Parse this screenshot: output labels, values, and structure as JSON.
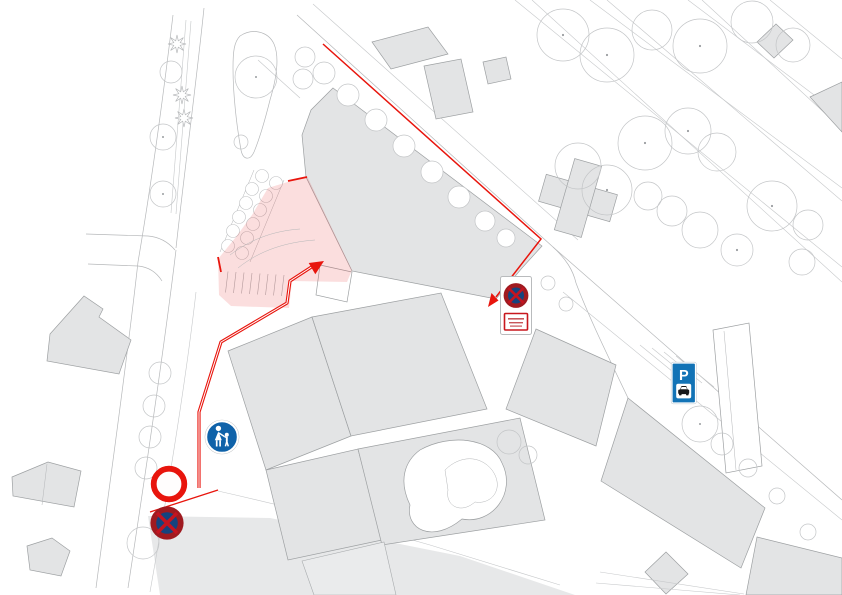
{
  "map": {
    "kind": "site-plan with pedestrian zone highlight and traffic signs",
    "colors": {
      "route_red": "#e8150d",
      "zone_pink": "rgba(230,60,60,0.17)",
      "sign_blue": "#0f62a9",
      "parking_blue": "#1273b6",
      "no_stop_ring": "#9f1a20",
      "no_stop_blue": "#15437e",
      "no_stop_cross": "#c41420",
      "building_gray": "#e3e4e5"
    },
    "highlight_zone": {
      "fill": "rgba(230,60,60,0.17)",
      "points": "268,188 307,176 352,270 347,282 292,281 289,308 231,306 219,295 218,259 236,237 252,215",
      "edge_top": "M288,181 L307,177",
      "edge_left": "M218,257 L221,272"
    },
    "route": {
      "street_line": {
        "points": "323,44 541,239 496,297"
      },
      "street_arrowhead": {
        "points": "488,307 498.5,300.5 491.5,293"
      },
      "walk_line": {
        "points": "199,488 199,412 221,342 287,303 290,281 313,266"
      },
      "walk_arrowhead": {
        "points": "324,261 315.3,274.2 308.7,263"
      },
      "street_edge_mark": {
        "points": "150,512 218,490"
      }
    },
    "signs": {
      "pedestrian_zone": {
        "icon": "pedestrian-zone-sign",
        "transform": "translate(222,437)"
      },
      "no_vehicles": {
        "icon": "no-vehicles-sign",
        "transform": "translate(169,484)"
      },
      "no_stopping": {
        "icon": "no-stopping-sign",
        "transform": "translate(167,523)"
      },
      "no_stopping_board": {
        "icon": "no-stopping-sign-with-plate",
        "transform": "translate(500,276)"
      },
      "parking": {
        "icon": "parking-sign",
        "label": "P",
        "transform": "translate(672,363)"
      }
    }
  }
}
